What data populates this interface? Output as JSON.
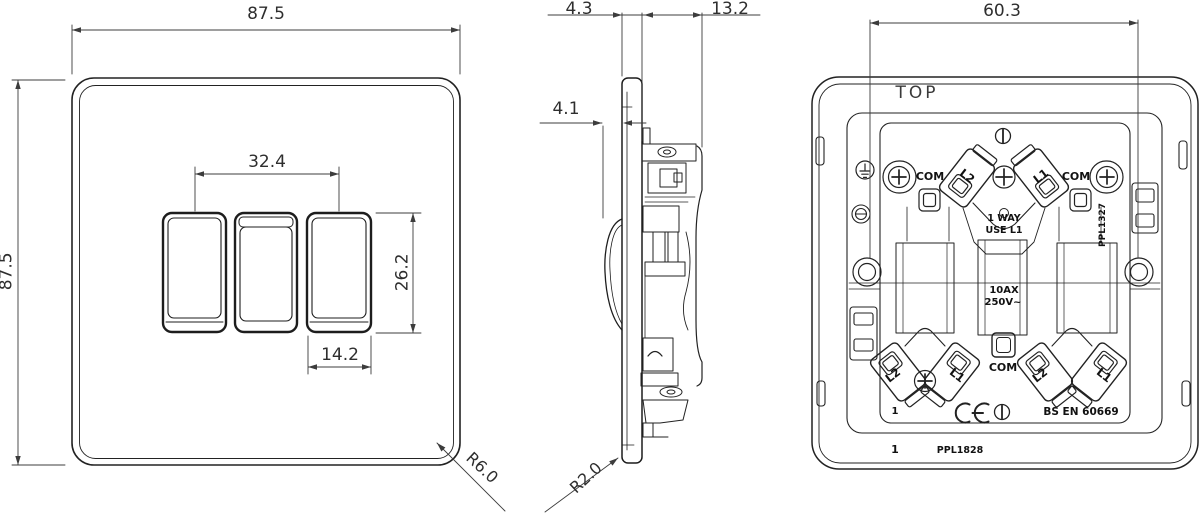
{
  "drawing": {
    "front": {
      "width_dim": "87.5",
      "height_dim": "87.5",
      "rocker_spacing_dim": "32.4",
      "rocker_height_dim": "26.2",
      "rocker_width_dim": "14.2",
      "corner_radius_dim": "R6.0"
    },
    "side": {
      "plate_thickness_dim": "4.3",
      "mechanism_depth_dim": "13.2",
      "rocker_projection_dim": "4.1",
      "edge_radius_dim": "R2.0"
    },
    "back": {
      "mounting_centres_dim": "60.3",
      "top_label": "TOP",
      "upper": {
        "com_left": "COM",
        "l2": "L2",
        "l1": "L1",
        "com_right": "COM",
        "way_note1": "1 WAY",
        "way_note2": "USE L1",
        "part_no": "PPL1327"
      },
      "rating1": "10AX",
      "rating2": "250V~",
      "lower": {
        "l2_a": "L2",
        "l1_a": "L1",
        "com": "COM",
        "l2_b": "L2",
        "l1_b": "L1"
      },
      "cert": {
        "gang": "1",
        "standard": "BS EN 60669"
      },
      "footer": {
        "qty": "1",
        "part_no": "PPL1828"
      }
    },
    "icons": {
      "ce_mark": "CE",
      "slotted_screw": "vertical-slot-screw-head",
      "cross_screw": "phillips-screw-head",
      "earth": "earth-ground-symbol"
    },
    "colors": {
      "line": "#222222",
      "dim_line": "#3c3c3c",
      "background": "#ffffff"
    }
  }
}
